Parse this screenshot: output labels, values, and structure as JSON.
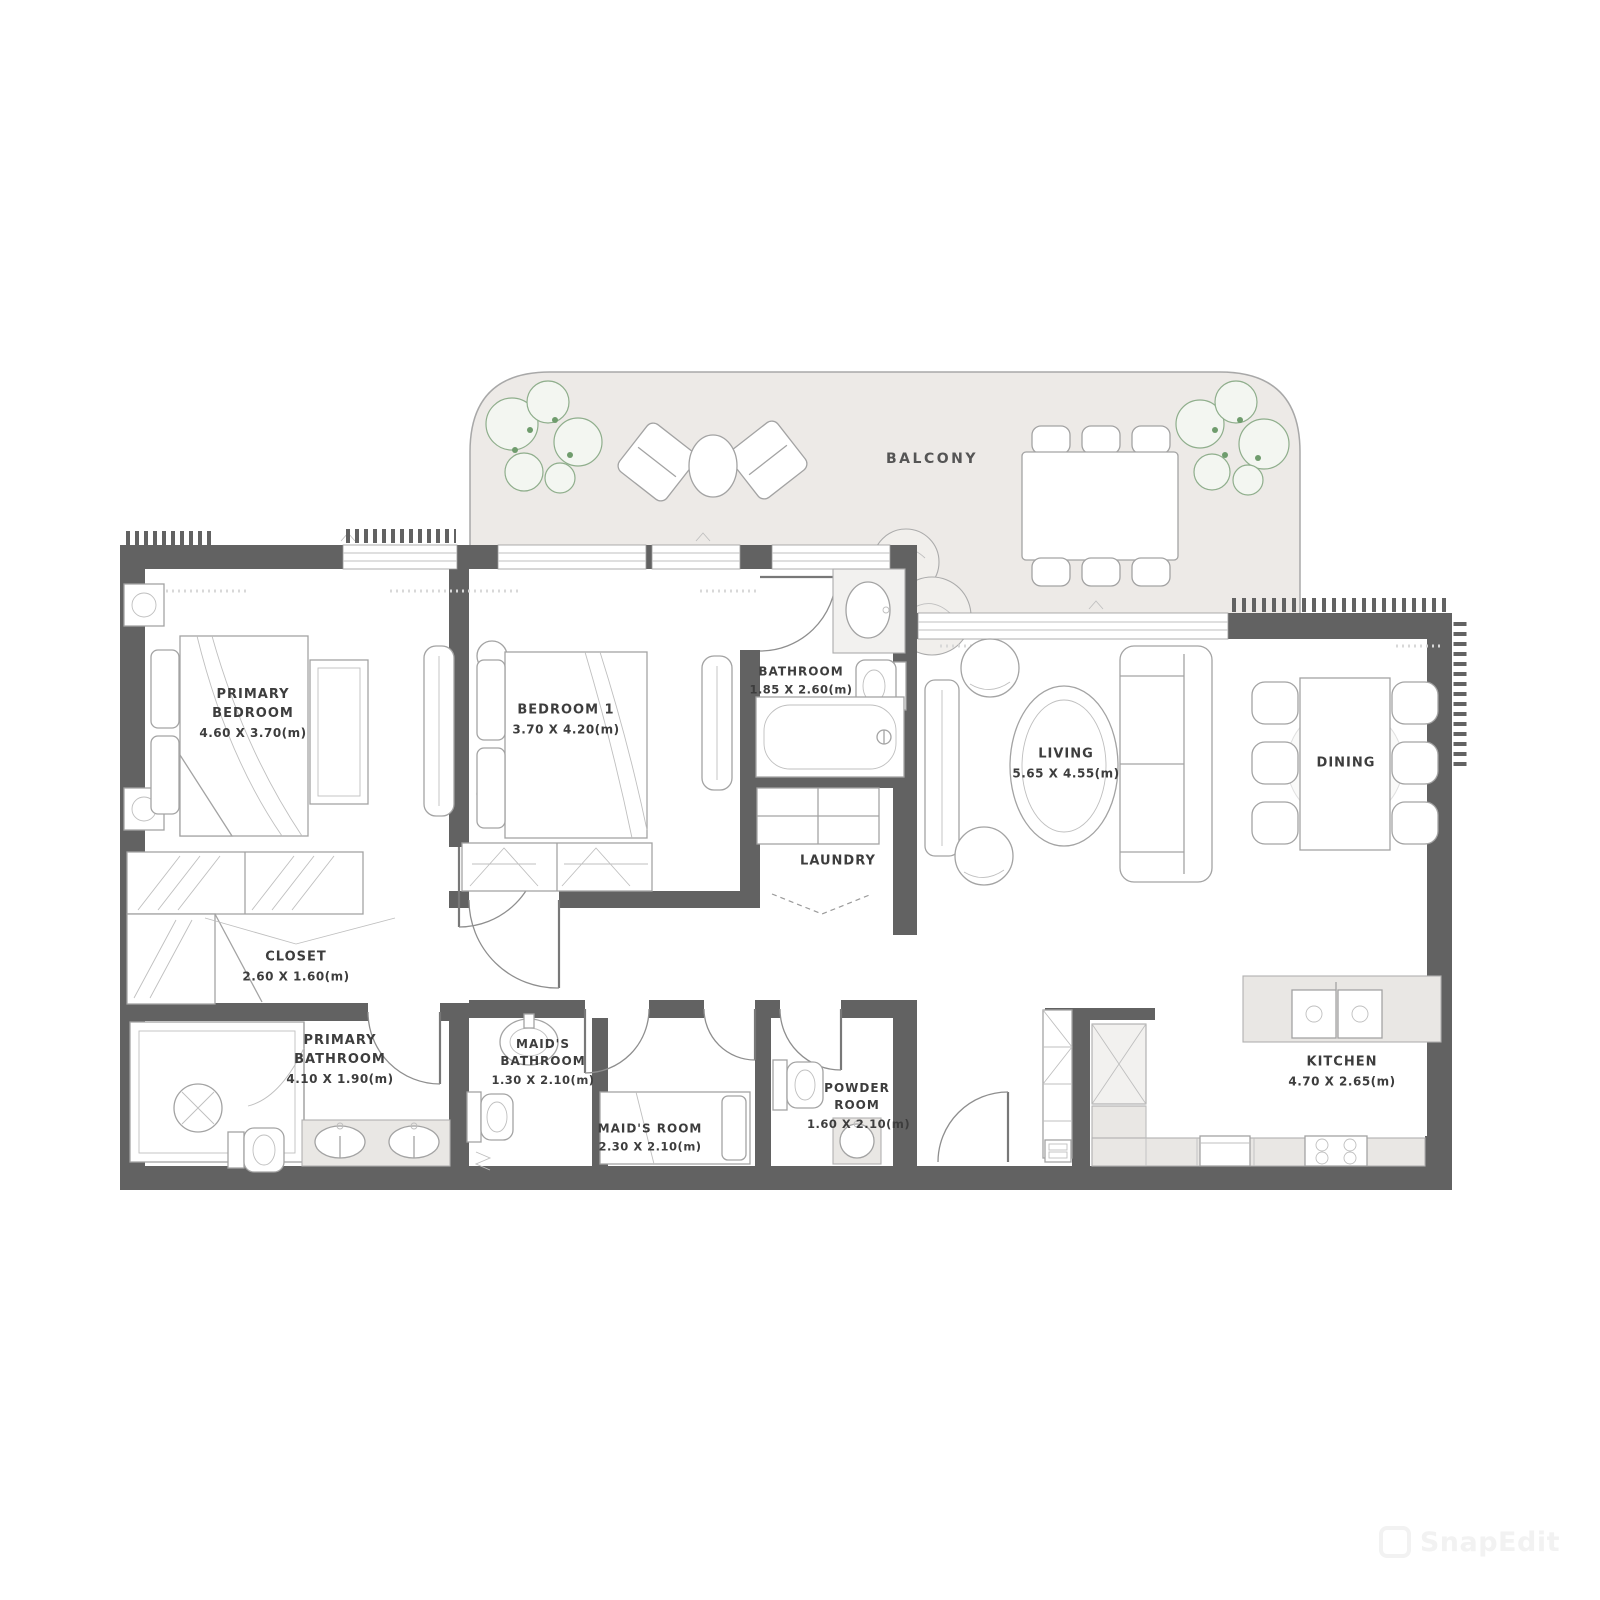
{
  "rooms": {
    "balcony": {
      "name": "BALCONY"
    },
    "primary_bedroom": {
      "name": "PRIMARY BEDROOM",
      "dims": "4.60 X 3.70(m)"
    },
    "bedroom_1": {
      "name": "BEDROOM 1",
      "dims": "3.70 X 4.20(m)"
    },
    "bathroom": {
      "name": "BATHROOM",
      "dims": "1.85 X 2.60(m)"
    },
    "living": {
      "name": "LIVING",
      "dims": "5.65 X 4.55(m)"
    },
    "dining": {
      "name": "DINING"
    },
    "laundry": {
      "name": "LAUNDRY"
    },
    "closet": {
      "name": "CLOSET",
      "dims": "2.60 X 1.60(m)"
    },
    "primary_bathroom": {
      "name": "PRIMARY BATHROOM",
      "dims": "4.10 X 1.90(m)"
    },
    "maids_bathroom": {
      "name": "MAID'S BATHROOM",
      "dims": "1.30 X 2.10(m)"
    },
    "maids_room": {
      "name": "MAID'S ROOM",
      "dims": "2.30 X 2.10(m)"
    },
    "powder_room": {
      "name": "POWDER ROOM",
      "dims": "1.60 X 2.10(m)"
    },
    "kitchen": {
      "name": "KITCHEN",
      "dims": "4.70 X 2.65(m)"
    }
  },
  "watermark": {
    "label": "SnapEdit"
  },
  "colors": {
    "wall": "#626262",
    "balcony_floor": "#EDEAE7",
    "plant_green": "#8FAE8C",
    "furniture_line": "#A3A3A3",
    "counter_fill": "#E9E7E4",
    "label_text": "#3D3D3D"
  }
}
